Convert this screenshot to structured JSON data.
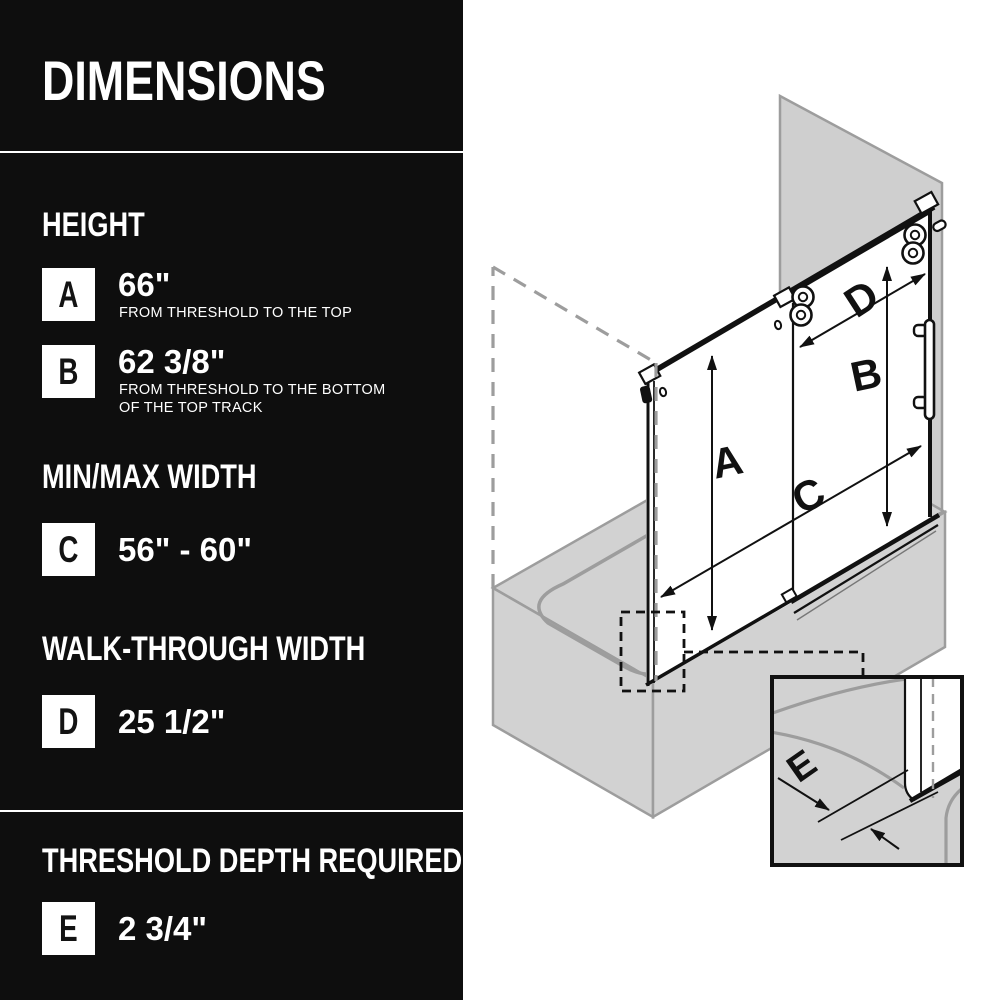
{
  "panel": {
    "title": "DIMENSIONS",
    "sections": [
      {
        "heading": "HEIGHT",
        "rows": [
          {
            "letter": "A",
            "value": "66\"",
            "caption": [
              "FROM THRESHOLD TO THE TOP"
            ]
          },
          {
            "letter": "B",
            "value": "62 3/8\"",
            "caption": [
              "FROM THRESHOLD TO THE BOTTOM",
              "OF THE TOP TRACK"
            ]
          }
        ]
      },
      {
        "heading": "MIN/MAX WIDTH",
        "rows": [
          {
            "letter": "C",
            "value": "56\" - 60\"",
            "caption": []
          }
        ]
      },
      {
        "heading": "WALK-THROUGH WIDTH",
        "rows": [
          {
            "letter": "D",
            "value": "25 1/2\"",
            "caption": []
          }
        ]
      },
      {
        "heading": "THRESHOLD DEPTH REQUIRED",
        "rows": [
          {
            "letter": "E",
            "value": "2 3/4\"",
            "caption": []
          }
        ]
      }
    ]
  },
  "diagram": {
    "labels": {
      "a": "A",
      "b": "B",
      "c": "C",
      "d": "D",
      "e": "E"
    },
    "colors": {
      "panel_bg": "#0e0e0e",
      "panel_text": "#ffffff",
      "surface_gray": "#d2d2d2",
      "line_gray": "#9d9d9d",
      "ink": "#111111"
    }
  }
}
